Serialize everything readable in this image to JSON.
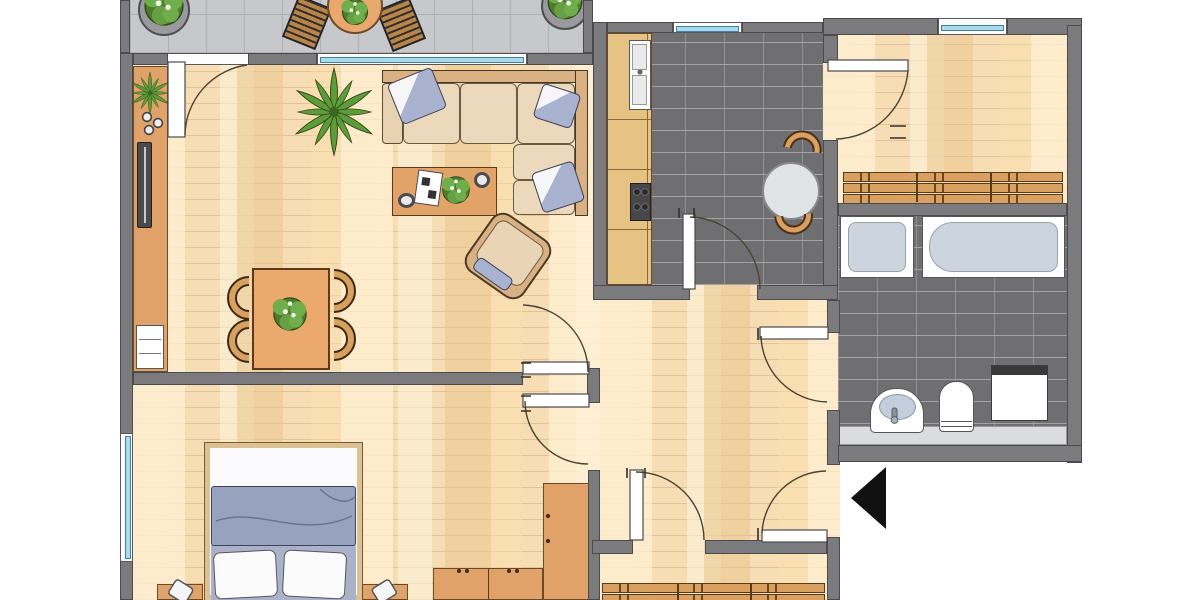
{
  "document": {
    "type": "apartment-floor-plan",
    "view": "top-down",
    "scale_text": ""
  },
  "colors": {
    "wall": "#7b7b7e",
    "parquet": "#f7ddb3",
    "dark_tile": "#6f6f72",
    "balcony_tile": "#c7c8cb",
    "wood_furniture": "#e0a269",
    "counter_wood": "#e6c382",
    "sofa_beige": "#e7d2b2",
    "pillow_blue": "#a9b2ce",
    "blanket_blue": "#97a2bf",
    "plant_green": "#5e9c39",
    "window_glass": "#a8dcec",
    "fixture_white": "#ffffff",
    "entrance_arrow": "#111111"
  },
  "rooms": [
    {
      "id": "balcony",
      "label": "balcony",
      "floor": "gray-tile",
      "furniture": [
        "round-table",
        "chair-left",
        "chair-right",
        "potted-plant-left",
        "potted-plant-right",
        "table-plant"
      ]
    },
    {
      "id": "living-room",
      "label": "living-room",
      "floor": "parquet",
      "furniture": [
        "corner-sofa",
        "sofa-pillows-x3",
        "coffee-table",
        "book",
        "flower-bouquet",
        "bowls-x2",
        "armchair",
        "palm-plant",
        "dining-table",
        "dining-chairs-x4",
        "centerpiece-plant",
        "sideboard",
        "sideboard-plant",
        "decor-bowls-x3",
        "tv",
        "wall-shelf"
      ]
    },
    {
      "id": "kitchen",
      "label": "kitchen",
      "floor": "dark-tile",
      "furniture": [
        "counter-run",
        "double-sink",
        "stove-4-burners",
        "round-table",
        "chairs-x2"
      ]
    },
    {
      "id": "storage-room",
      "label": "storage-room",
      "floor": "parquet",
      "furniture": [
        "slatted-shelf-unit-3-rows"
      ]
    },
    {
      "id": "bathroom",
      "label": "bathroom",
      "floor": "dark-tile",
      "furniture": [
        "shower-tray",
        "bathtub",
        "washbasin",
        "toilet",
        "washing-machine",
        "ledge"
      ]
    },
    {
      "id": "hallway",
      "label": "hallway",
      "floor": "parquet",
      "furniture": []
    },
    {
      "id": "bedroom",
      "label": "bedroom",
      "floor": "parquet",
      "furniture": [
        "double-bed",
        "blanket",
        "pillows-x2",
        "nightstand-left",
        "nightstand-right",
        "lamp-left",
        "lamp-right",
        "wardrobe-corner",
        "wardrobe-bottom"
      ]
    },
    {
      "id": "lower-room",
      "label": "room-partially-visible",
      "floor": "parquet",
      "furniture": [
        "slatted-shelf-unit-2-rows"
      ]
    }
  ],
  "doors": [
    "balcony-door",
    "living-room-door",
    "bedroom-door",
    "kitchen-door",
    "storage-room-door",
    "bathroom-door",
    "lower-room-door",
    "entrance-door"
  ],
  "windows": [
    "living-room-window",
    "kitchen-window",
    "storage-room-window",
    "bedroom-window"
  ],
  "entrance": {
    "marker": "black-triangle-arrow",
    "points": "left"
  }
}
